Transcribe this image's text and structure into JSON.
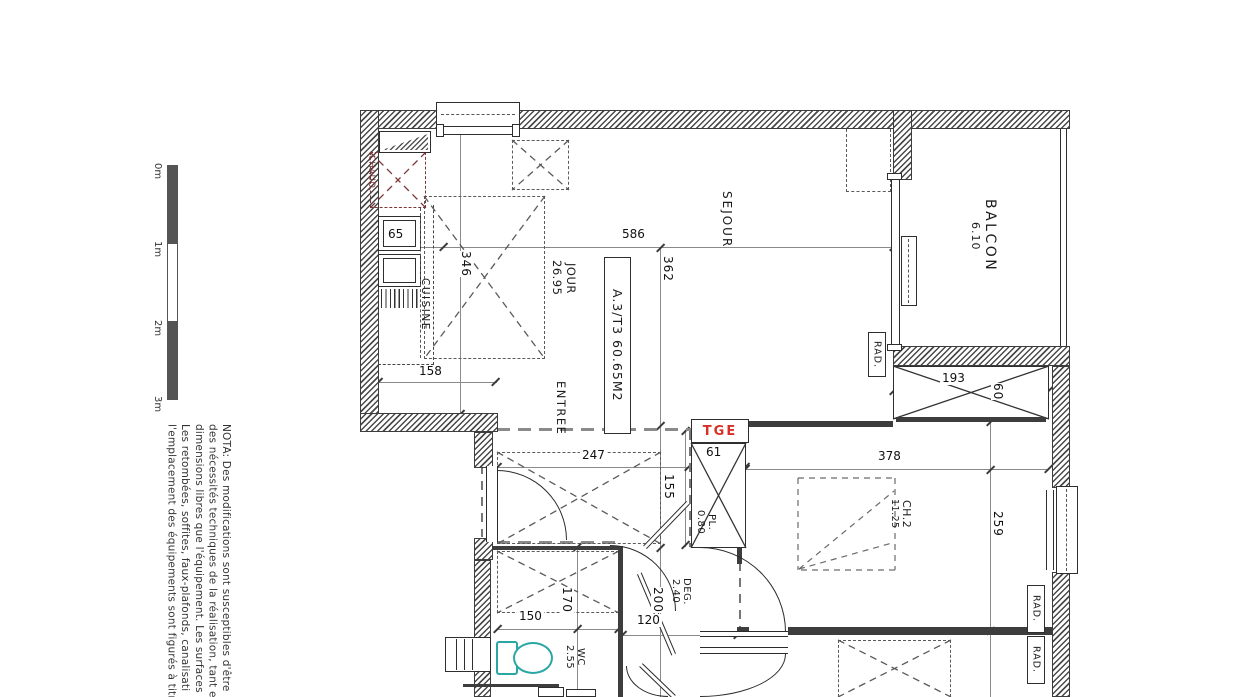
{
  "scale_bar": {
    "labels": [
      "0m",
      "1m",
      "2m",
      "3m"
    ]
  },
  "nota": {
    "lines": [
      "NOTA: Des modifications sont susceptibles d'être",
      "des nécessités techniques de la réalisation, tant e",
      "dimensions libres que l'équipement. Les surfaces",
      "Les retombées, soffites, faux-plafonds, canalisati",
      "l'emplacement des équipements sont figurés à titr"
    ]
  },
  "apartment": {
    "label": "A.3/T3 60.65M2"
  },
  "rooms": {
    "cuisine": {
      "name": "CUISINE"
    },
    "sejour": {
      "name": "SEJOUR",
      "sub": "JOUR",
      "area": "26.95"
    },
    "balcon": {
      "name": "BALCON",
      "area": "6.10"
    },
    "entree": {
      "name": "ENTREE"
    },
    "placard": {
      "name": "PL.",
      "area": "0.80"
    },
    "degagement": {
      "name": "DEG.",
      "area": "2.40"
    },
    "wc": {
      "name": "WC",
      "area": "2.55"
    },
    "ch2": {
      "name": "CH.2",
      "area": "11.25"
    }
  },
  "equipment": {
    "chaud": "CHAUD.",
    "tge": "TGE",
    "rad": "RAD."
  },
  "dimensions": {
    "d586": "586",
    "d362": "362",
    "d346": "346",
    "d65": "65",
    "d158": "158",
    "d247": "247",
    "d155": "155",
    "d61": "61",
    "d378": "378",
    "d193": "193",
    "d60": "60",
    "d259": "259",
    "d150": "150",
    "d170": "170",
    "d120": "120",
    "d200": "200"
  },
  "colors": {
    "wall": "#3d3d3d",
    "dim_line": "#8a8a8a",
    "chaud_red": "#7d3535",
    "tge_red": "#d93025",
    "toilet_teal": "#2aa7a3",
    "dashed_gray": "#5a5a5a"
  }
}
